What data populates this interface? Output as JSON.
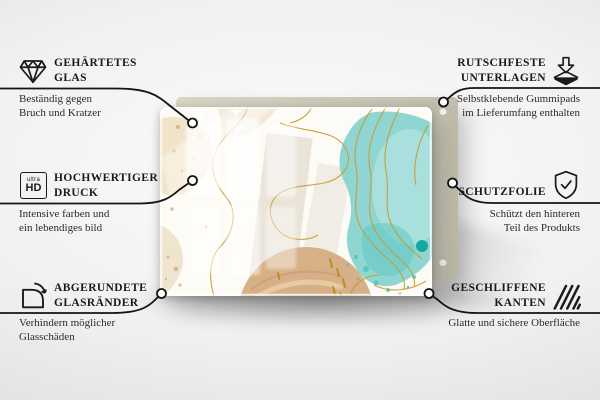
{
  "page": {
    "language": "de",
    "background_color": "#e9e9e9"
  },
  "product": {
    "kind": "glass-board-with-abstract-print",
    "colors": {
      "backing_board": "#c8c5b5",
      "glass_base": "#fdfbf5",
      "beige_blob": "#efe0c2",
      "tan_circle": "#d7b087",
      "teal_blob": "#7fd0cd",
      "teal_dark_dot": "#17a7a2",
      "gold_lines": "#c9992f",
      "callout_line": "#141414"
    }
  },
  "features": [
    {
      "id": "tempered-glass",
      "side": "left",
      "icon": "diamond-icon",
      "title_line1": "GEHÄRTETES",
      "title_line2": "GLAS",
      "desc_line1": "Beständig gegen",
      "desc_line2": "Bruch und Kratzer"
    },
    {
      "id": "high-quality-print",
      "side": "left",
      "icon": "ultra-hd-icon",
      "icon_text_top": "ultra",
      "icon_text_bottom": "HD",
      "title_line1": "HOCHWERTIGER",
      "title_line2": "DRUCK",
      "desc_line1": "Intensive farben und",
      "desc_line2": "ein lebendiges bild"
    },
    {
      "id": "rounded-glass-edges",
      "side": "left",
      "icon": "rounded-corner-icon",
      "title_line1": "ABGERUNDETE",
      "title_line2": "GLASRÄNDER",
      "desc_line1": "Verhindern möglicher",
      "desc_line2": "Glasschäden"
    },
    {
      "id": "non-slip-pads",
      "side": "right",
      "icon": "non-slip-pads-icon",
      "title_line1": "RUTSCHFESTE",
      "title_line2": "UNTERLAGEN",
      "desc_line1": "Selbstklebende Gummipads",
      "desc_line2": "im Lieferumfang enthalten"
    },
    {
      "id": "protective-film",
      "side": "right",
      "icon": "shield-check-icon",
      "title_line1": "SCHUTZFOLIE",
      "title_line2": "",
      "desc_line1": "Schützt den hinteren",
      "desc_line2": "Teil des Produkts"
    },
    {
      "id": "polished-edges",
      "side": "right",
      "icon": "polished-edges-icon",
      "title_line1": "GESCHLIFFENE",
      "title_line2": "KANTEN",
      "desc_line1": "Glatte und sichere Oberfläche",
      "desc_line2": ""
    }
  ]
}
